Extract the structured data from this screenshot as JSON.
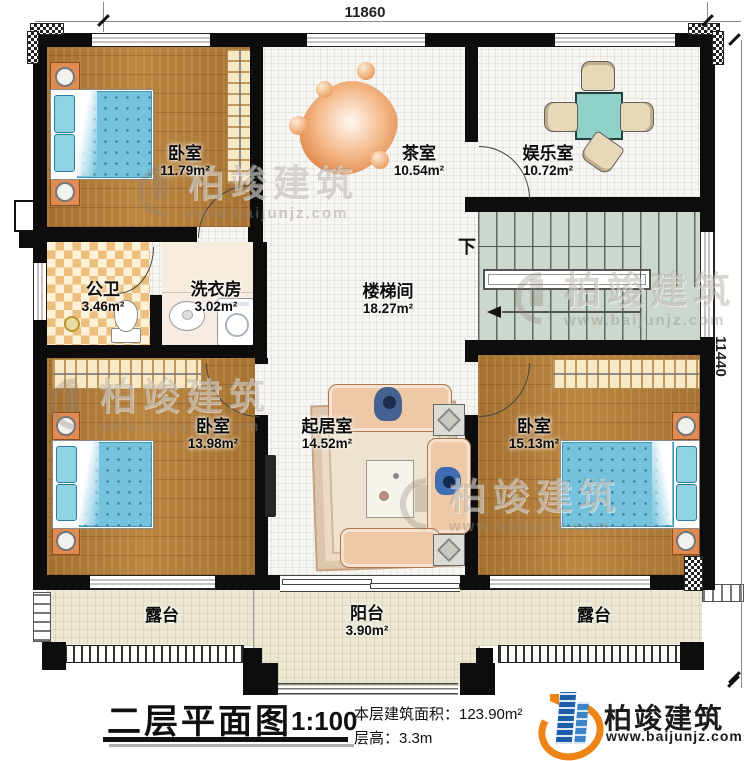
{
  "dimensions": {
    "top": "11860",
    "right": "11440"
  },
  "rooms": {
    "bedroom_tl": {
      "name": "卧室",
      "area": "11.79m²"
    },
    "tea": {
      "name": "茶室",
      "area": "10.54m²"
    },
    "entertainment": {
      "name": "娱乐室",
      "area": "10.72m²"
    },
    "bathroom": {
      "name": "公卫",
      "area": "3.46m²"
    },
    "laundry": {
      "name": "洗衣房",
      "area": "3.02m²"
    },
    "stairhall": {
      "name": "楼梯间",
      "area": "18.27m²"
    },
    "bedroom_bl": {
      "name": "卧室",
      "area": "13.98m²"
    },
    "living": {
      "name": "起居室",
      "area": "14.52m²"
    },
    "bedroom_br": {
      "name": "卧室",
      "area": "15.13m²"
    },
    "terrace_left": {
      "name": "露台"
    },
    "balcony": {
      "name": "阳台",
      "area": "3.90m²"
    },
    "terrace_right": {
      "name": "露台"
    }
  },
  "stairs": {
    "down": "下"
  },
  "watermark": {
    "brand": "柏竣建筑",
    "site": "www.baijunjz.com"
  },
  "title_block": {
    "title": "二层平面图",
    "scale": "1:100",
    "floor_area": "本层建筑面积：123.90m²",
    "floor_height": "层高：3.3m"
  },
  "brand": {
    "name": "柏竣建筑",
    "site": "www.baijunjz.com"
  },
  "colors": {
    "wall": "#0d0d0d",
    "wood_floor": "#b5803d",
    "tile_floor": "#f7f6f2",
    "terrace_floor": "#ebe7d2",
    "stair_floor": "#ccd7ce",
    "bed_blue": "#74c2dd",
    "wardrobe_cream": "#f8e9c4",
    "nightstand_orange": "#e08b52",
    "table_teal": "#8fd0c8",
    "logo_blue": "#1c5fa8",
    "logo_orange": "#ee8316"
  }
}
